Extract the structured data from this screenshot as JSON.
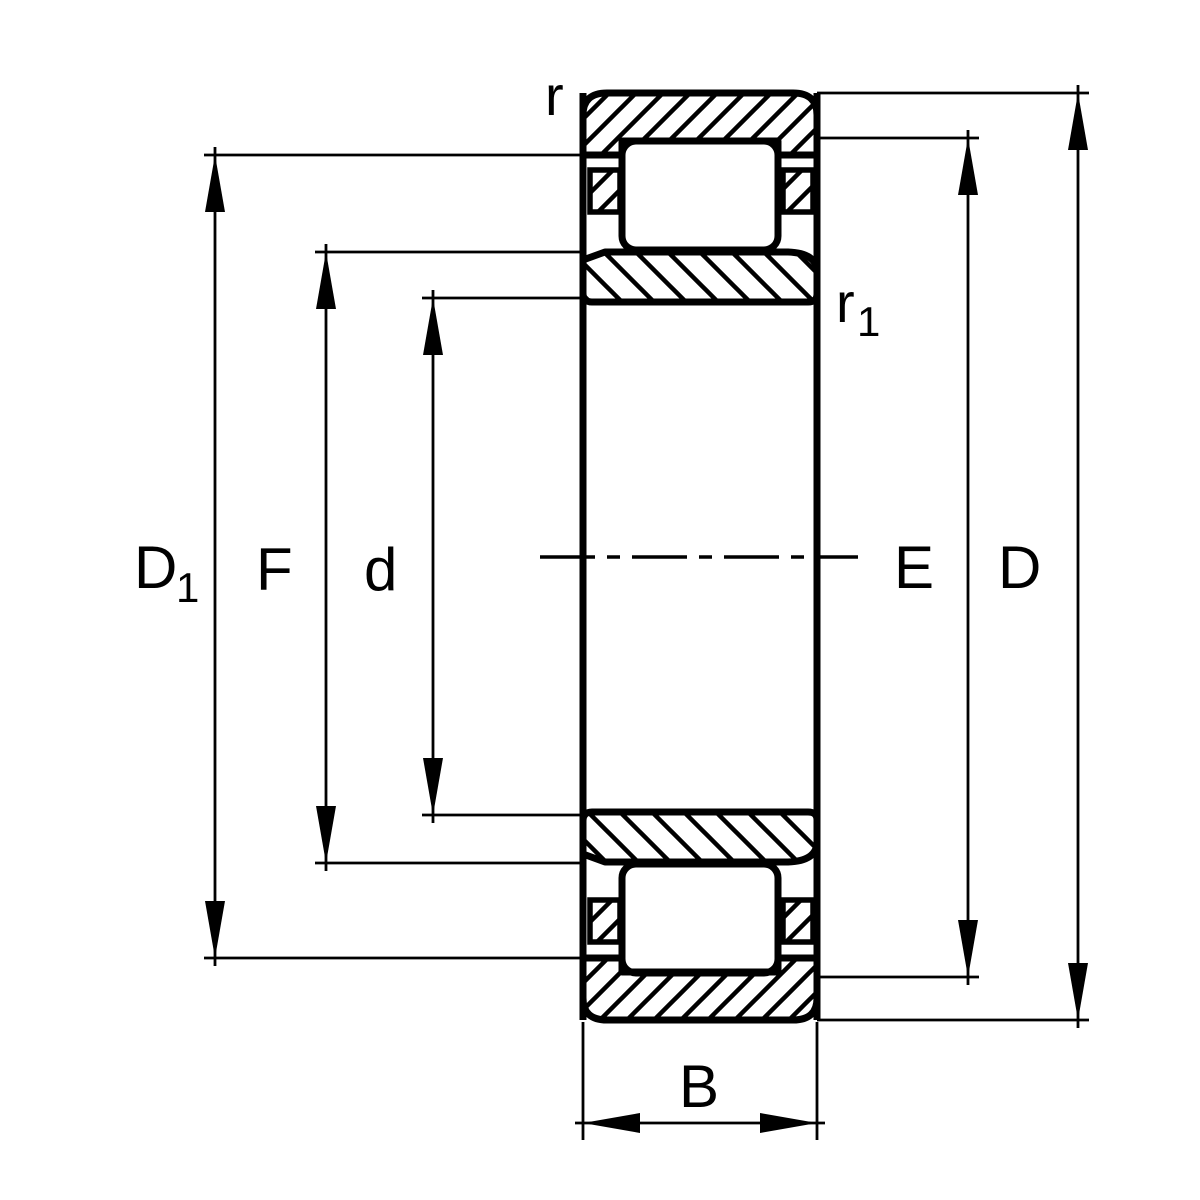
{
  "figure": {
    "background": "#ffffff",
    "line_color": "#000000",
    "labels": {
      "r": "r",
      "r1": {
        "base": "r",
        "sub": "1"
      },
      "D1": {
        "base": "D",
        "sub": "1"
      },
      "F": "F",
      "d": "d",
      "E": "E",
      "D": "D",
      "B": "B"
    }
  }
}
